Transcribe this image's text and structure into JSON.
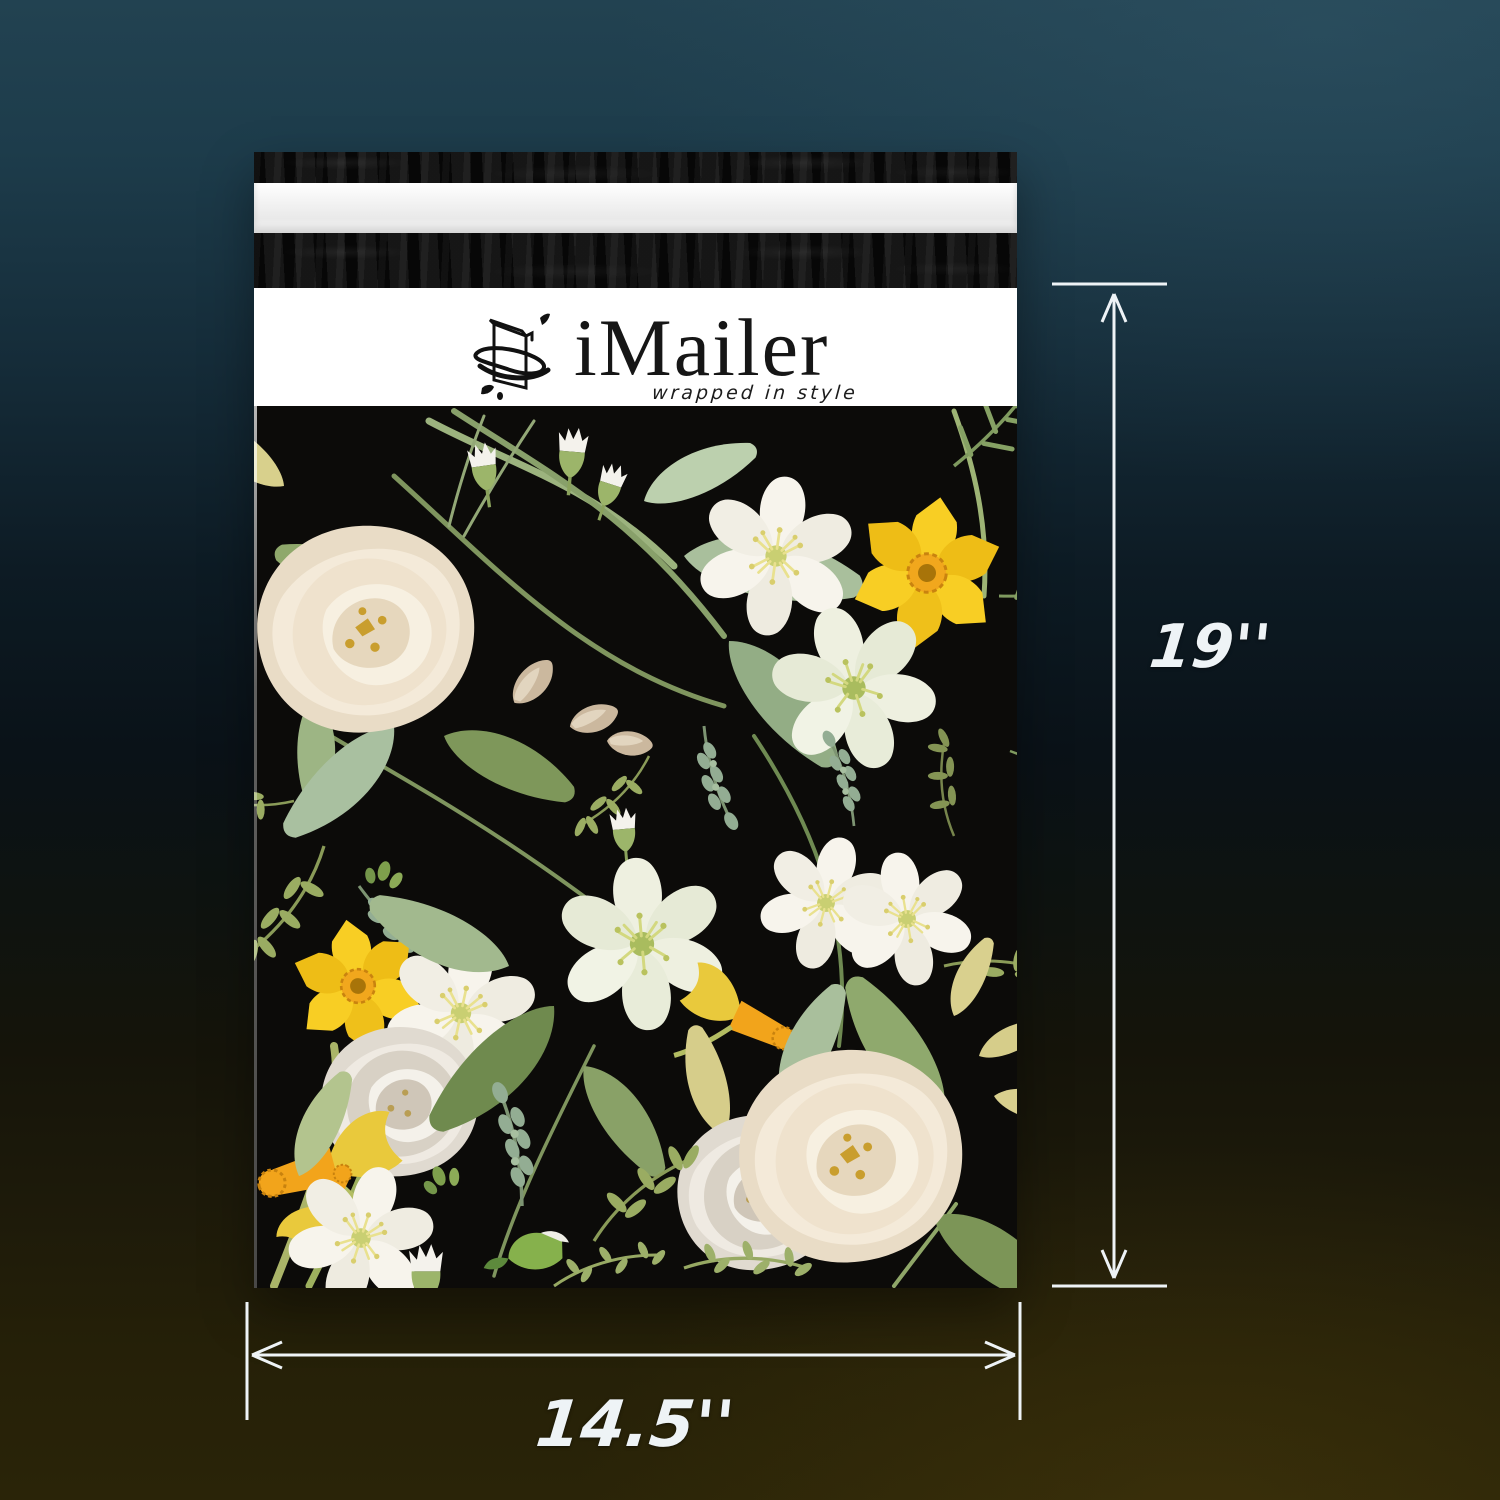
{
  "scene": {
    "kind": "product image of a printed poly mailer with size annotations",
    "background": {
      "top_color": "#224251",
      "middle_color": "#0a1218",
      "bottom_color": "#2a2408"
    }
  },
  "brand": {
    "name": "iMailer",
    "tagline": "wrapped in style",
    "logo_icon": "book-swoosh-icon",
    "text_color": "#161616"
  },
  "envelope": {
    "kind": "floral poly mailer bag",
    "flap_color": "#0f0f0f",
    "seal_strip_color": "#f2f2f2",
    "logo_band_color": "#ffffff",
    "panel_background": "#0c0b09",
    "pattern": "white roses, hellebores and yellow daffodils with green leaves on black",
    "palette": {
      "cream_rose": "#f0e6d4",
      "white_petal": "#f7f4ec",
      "daffodil_yellow": "#f8ce24",
      "daffodil_trumpet": "#f1a71d",
      "leaf_green": "#8aa266",
      "sage_green": "#a9bf9c"
    }
  },
  "annotations": {
    "height_label": "19''",
    "width_label": "14.5''",
    "line_color": "#eef3f6"
  }
}
